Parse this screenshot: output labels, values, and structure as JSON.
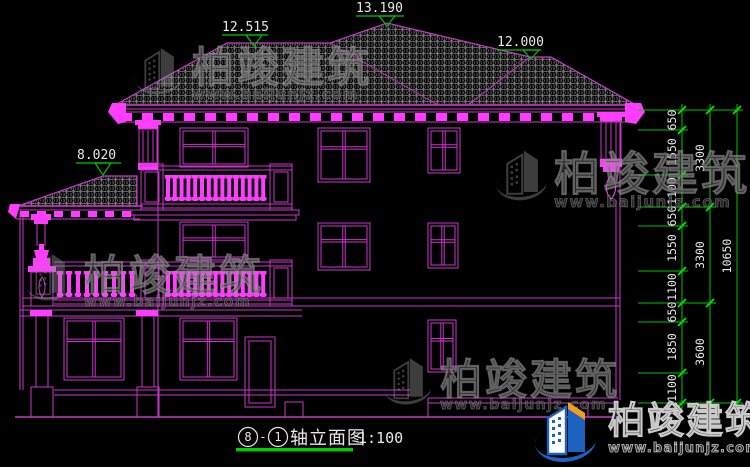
{
  "title_bar": {
    "axis_from": "8",
    "dash": "-",
    "axis_to": "1",
    "name": "轴立面图",
    "scale": "1:100"
  },
  "elevations": {
    "ridge_left": "12.515",
    "peak": "13.190",
    "ridge_right": "12.000",
    "porch": "8.020"
  },
  "dimensions": {
    "inner": [
      "650",
      "1550",
      "1100",
      "650",
      "1550",
      "1100",
      "650",
      "1850",
      "1100"
    ],
    "middle": [
      "3300",
      "3300",
      "3600"
    ],
    "total": "10650"
  },
  "watermark": {
    "brand": "柏竣建筑",
    "url": "www.baijunjz.com"
  },
  "footer_logo": {
    "brand": "柏竣建筑",
    "url": "www.baijunjz.com"
  },
  "colors": {
    "line_magenta": "#c837c8",
    "bright_magenta": "#ff3dff",
    "dim_green": "#00c400",
    "text_white": "#e8e8e8",
    "tile_gray": "#b9b9b9",
    "logo_blue": "#1e62bf",
    "logo_orange": "#f39c1f",
    "background": "#000000"
  }
}
